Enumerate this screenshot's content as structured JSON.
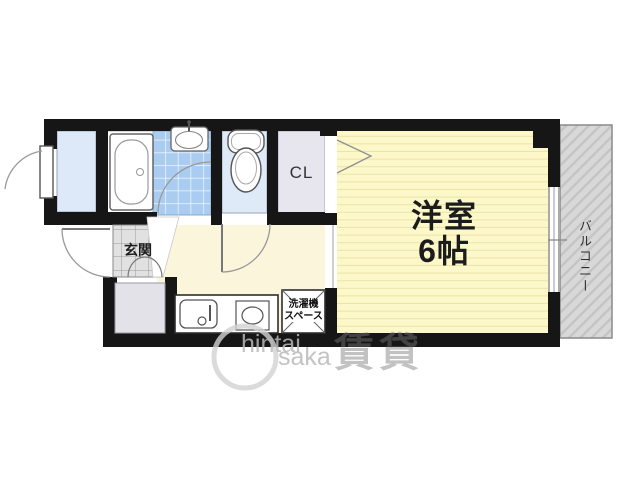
{
  "plan": {
    "rooms": {
      "main_room": {
        "line1": "洋室",
        "line2": "6帖"
      },
      "closet": "CL",
      "entrance": "玄関",
      "washer_space": {
        "line1": "洗濯機",
        "line2": "スペース"
      },
      "balcony": "バルコニー"
    },
    "watermark": {
      "text_top": "hintai",
      "text_bottom": "saka",
      "kanji": "賃貸"
    },
    "colors": {
      "wall": "#161616",
      "main_room_floor": "#fcf8ca",
      "main_room_stripe": "#ebe4a6",
      "kitchen_floor": "#fbf5dc",
      "wet_area_tile": "#a9ccf0",
      "hall_floor": "#dde9f8",
      "toilet_floor": "#dfeaf8",
      "closet_floor": "#e7e5ee",
      "genkan_tile": "#e1e1e1",
      "alcove_floor": "#e4e2e9",
      "balcony_bg": "#d8d8d8",
      "balcony_stripe": "#c4c4c4"
    }
  }
}
